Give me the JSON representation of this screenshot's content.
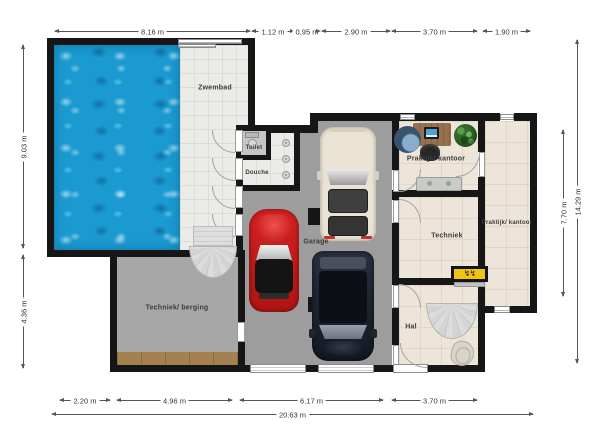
{
  "plan": {
    "type": "floorplan",
    "rooms": [
      {
        "id": "zwembad",
        "label": "Zwembad"
      },
      {
        "id": "toilet",
        "label": "Toilet"
      },
      {
        "id": "douche",
        "label": "Douche"
      },
      {
        "id": "techniek-berging",
        "label": "Techniek/ berging"
      },
      {
        "id": "garage",
        "label": "Garage"
      },
      {
        "id": "praktijk-kantoor-top",
        "label": "Praktijk/ kantoor"
      },
      {
        "id": "techniek",
        "label": "Techniek"
      },
      {
        "id": "hal",
        "label": "Hal"
      },
      {
        "id": "praktijk-kantoor-right",
        "label": "Praktijk/ kantoor"
      }
    ],
    "dimensions": {
      "top": [
        "8.16 m",
        "1.12 m",
        "0.95 m",
        "2.90 m",
        "3.70 m",
        "1.90 m"
      ],
      "left": [
        "9.03 m",
        "4.36 m"
      ],
      "right": [
        "7.70 m",
        "14.29 m"
      ],
      "bottom": [
        "2.20 m",
        "4.96 m",
        "6.17 m",
        "3.70 m"
      ],
      "bottom_total": "20.63 m"
    },
    "fixtures": [
      "pool-water",
      "spiral-stairs",
      "hal-stairs",
      "toilet",
      "shower-heads",
      "red-car",
      "white-van",
      "dark-suv",
      "garage-columns",
      "desk",
      "monitor",
      "office-chair",
      "tub-chair",
      "plant",
      "sideboard",
      "electrical-panel",
      "hal-chair"
    ],
    "colors": {
      "wall": "#161616",
      "pool_water": "#1a9ad0",
      "deck_tile": "#ebebe7",
      "garage_floor": "#9d9d9d",
      "berging_floor": "#a7a7a7",
      "beige_floor": "#ede5d9",
      "brown_tiles": "#a58050",
      "panel_yellow": "#f2c410",
      "car_red": "#cc1a1a",
      "van_cream": "#eae3d4",
      "suv_navy": "#1d2230"
    }
  }
}
